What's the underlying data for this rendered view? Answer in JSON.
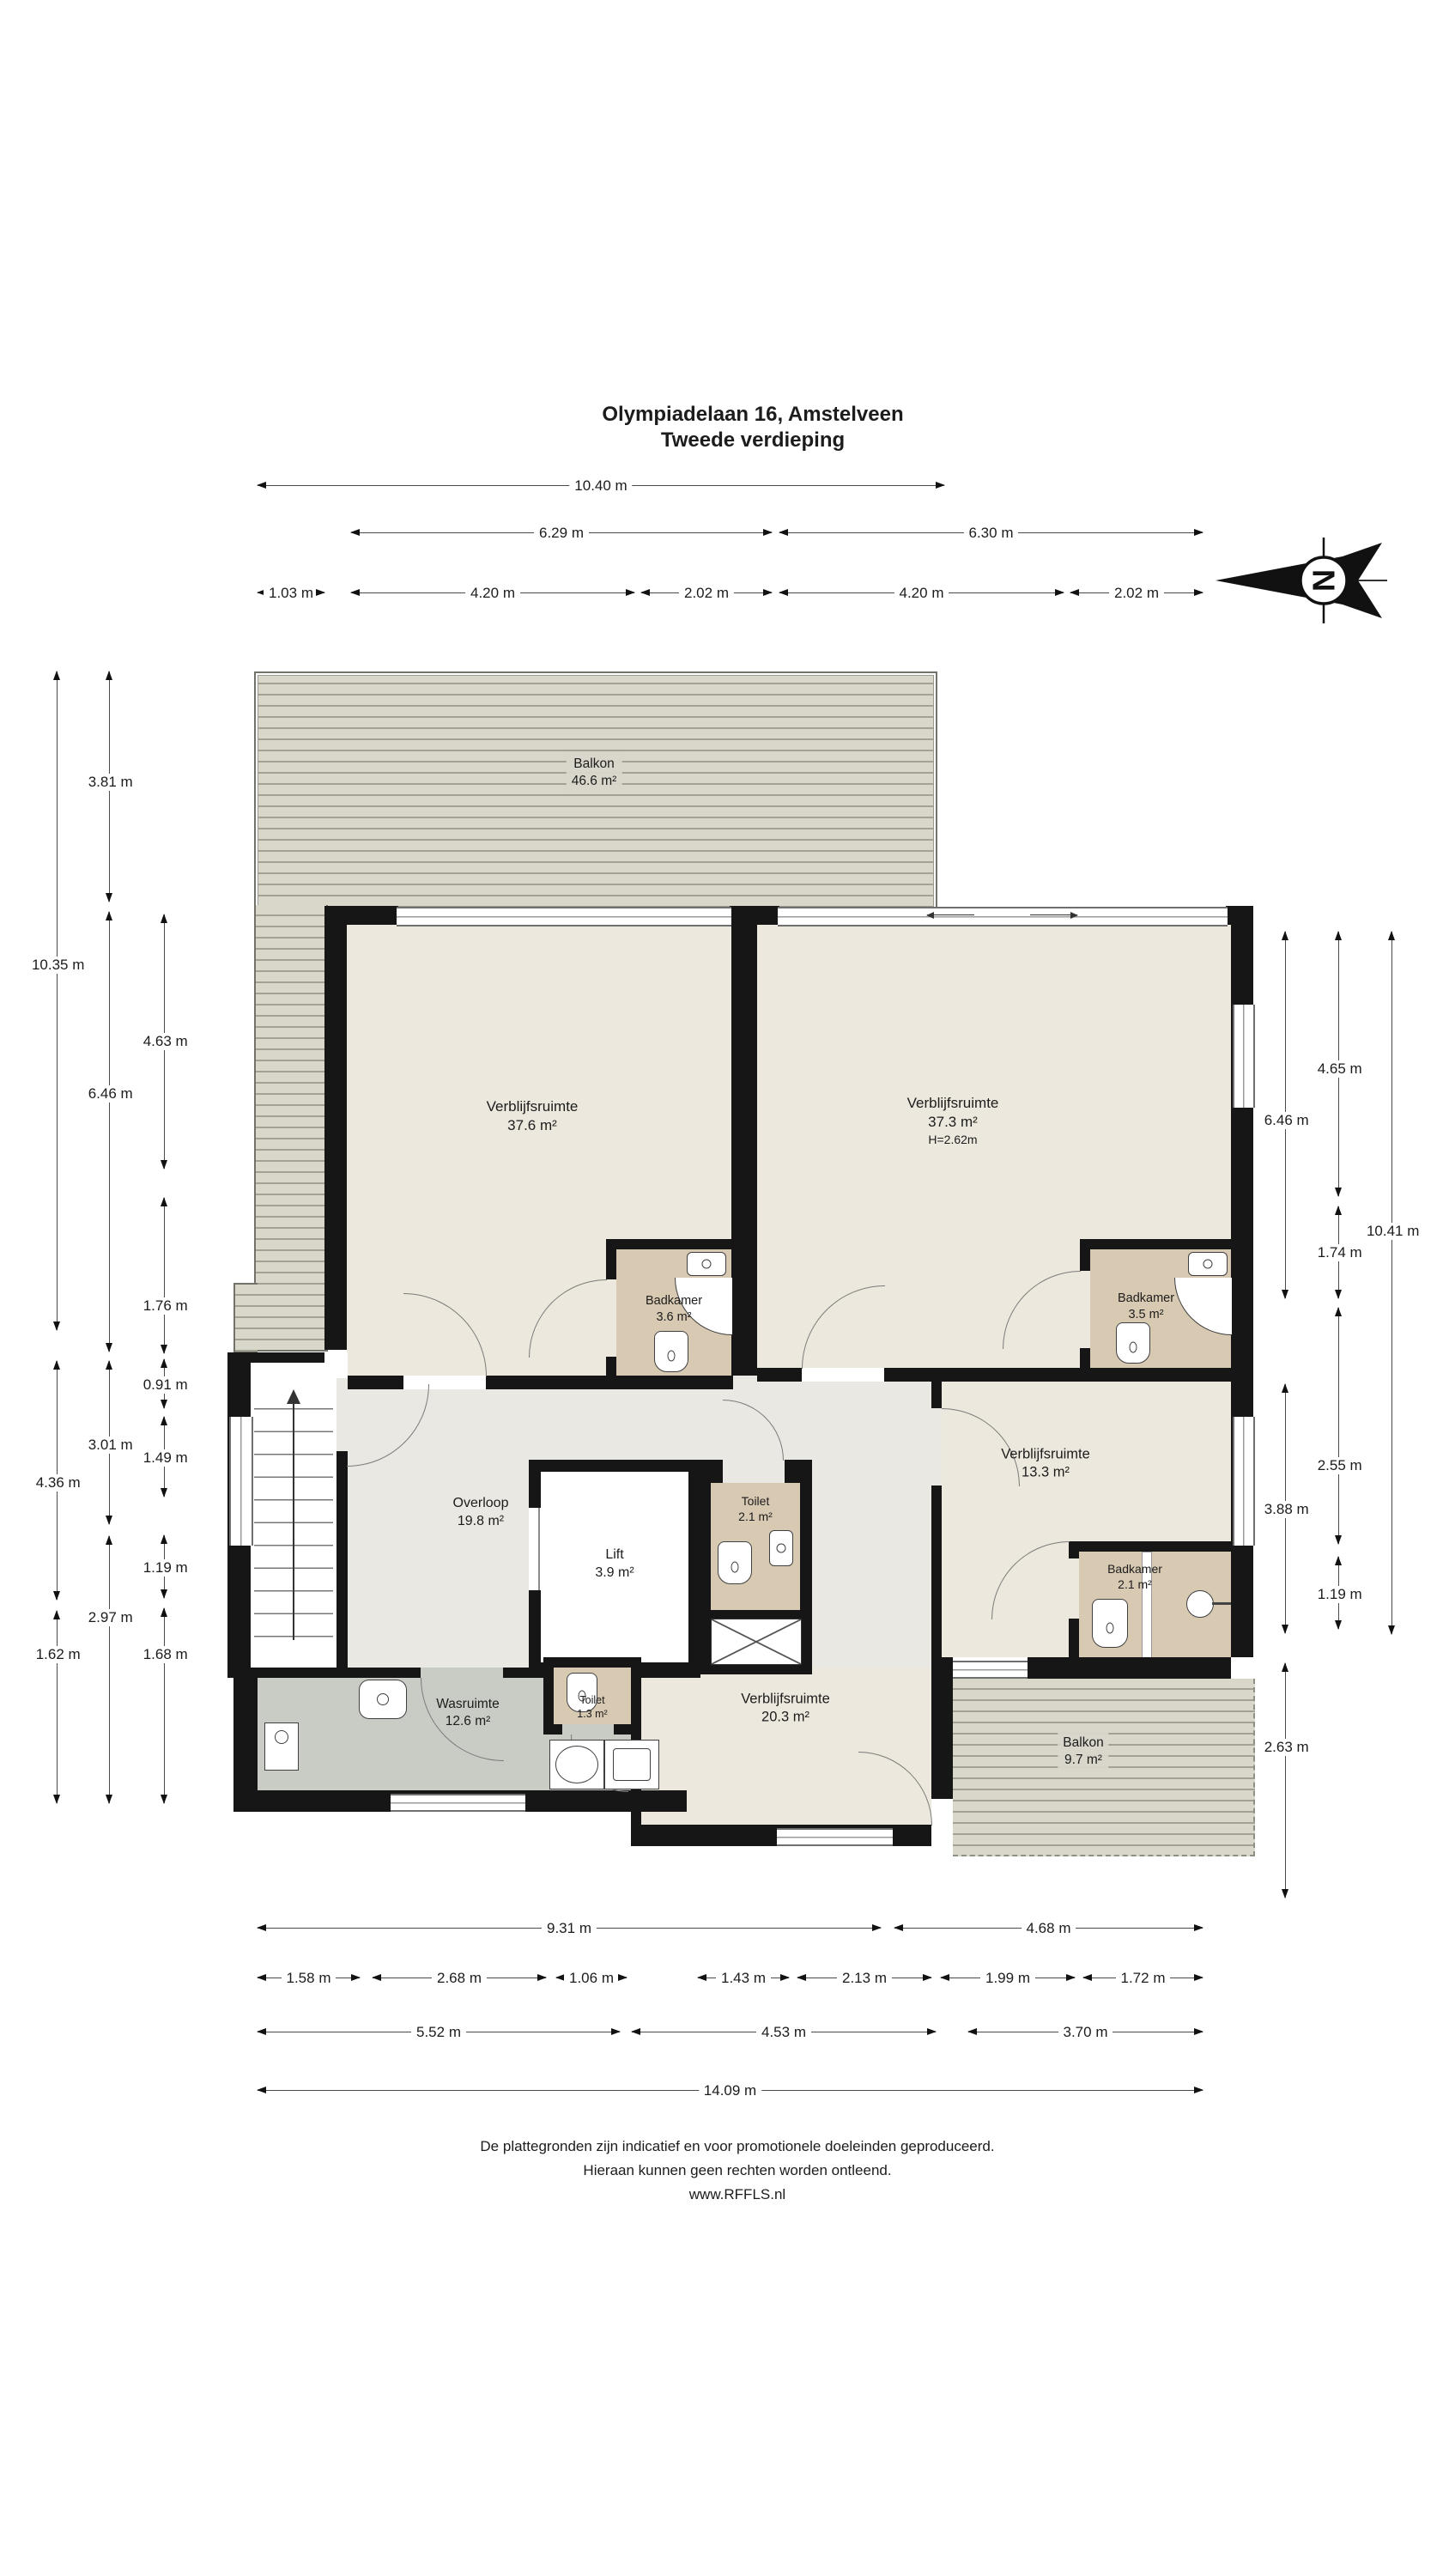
{
  "meta": {
    "address_title": "Olympiadelaan 16, Amstelveen",
    "floor_subtitle": "Tweede verdieping"
  },
  "compass": {
    "north_letter": "N"
  },
  "rooms": {
    "balkon_boven": {
      "name": "Balkon",
      "area": "46.6 m²"
    },
    "verblijfsruimte_links": {
      "name": "Verblijfsruimte",
      "area": "37.6 m²"
    },
    "verblijfsruimte_rechts": {
      "name": "Verblijfsruimte",
      "area": "37.3 m²",
      "height": "H=2.62m"
    },
    "badkamer_links": {
      "name": "Badkamer",
      "area": "3.6 m²"
    },
    "badkamer_rechts": {
      "name": "Badkamer",
      "area": "3.5 m²"
    },
    "overloop": {
      "name": "Overloop",
      "area": "19.8 m²"
    },
    "lift": {
      "name": "Lift",
      "area": "3.9 m²"
    },
    "toilet_bij_lift": {
      "name": "Toilet",
      "area": "2.1 m²"
    },
    "verblijfsruimte_midden": {
      "name": "Verblijfsruimte",
      "area": "13.3 m²"
    },
    "badkamer_midden": {
      "name": "Badkamer",
      "area": "2.1 m²"
    },
    "toilet_klein": {
      "name": "Toilet",
      "area": "1.3 m²"
    },
    "wasruimte": {
      "name": "Wasruimte",
      "area": "12.6 m²"
    },
    "verblijfsruimte_onder": {
      "name": "Verblijfsruimte",
      "area": "20.3 m²"
    },
    "balkon_onder": {
      "name": "Balkon",
      "area": "9.7 m²"
    }
  },
  "dimensions": {
    "top": [
      "10.40 m",
      "6.29 m",
      "6.30 m",
      "1.03 m",
      "4.20 m",
      "2.02 m",
      "4.20 m",
      "2.02 m"
    ],
    "left": [
      "3.81 m",
      "10.35 m",
      "4.63 m",
      "6.46 m",
      "1.76 m",
      "0.91 m",
      "3.01 m",
      "1.49 m",
      "4.36 m",
      "1.19 m",
      "2.97 m",
      "1.62 m",
      "1.68 m"
    ],
    "right": [
      "4.65 m",
      "6.46 m",
      "10.41 m",
      "1.74 m",
      "2.55 m",
      "3.88 m",
      "1.19 m",
      "2.63 m"
    ],
    "bottom": [
      "9.31 m",
      "4.68 m",
      "1.58 m",
      "2.68 m",
      "1.06 m",
      "1.43 m",
      "2.13 m",
      "1.99 m",
      "1.72 m",
      "5.52 m",
      "4.53 m",
      "3.70 m",
      "14.09 m"
    ]
  },
  "footer": {
    "line1": "De plattegronden zijn indicatief en voor promotionele doeleinden geproduceerd.",
    "line2": "Hieraan kunnen geen rechten worden ontleend.",
    "line3": "www.RFFLS.nl"
  },
  "colors": {
    "wall": "#161616",
    "room_floor": "#ece8dd",
    "bathroom_floor": "#d8c9b2",
    "laundry_floor": "#c9ccc4",
    "hall_floor": "#e9e8e2",
    "deck": "#d9d6ca",
    "deck_line": "#a3a094"
  }
}
